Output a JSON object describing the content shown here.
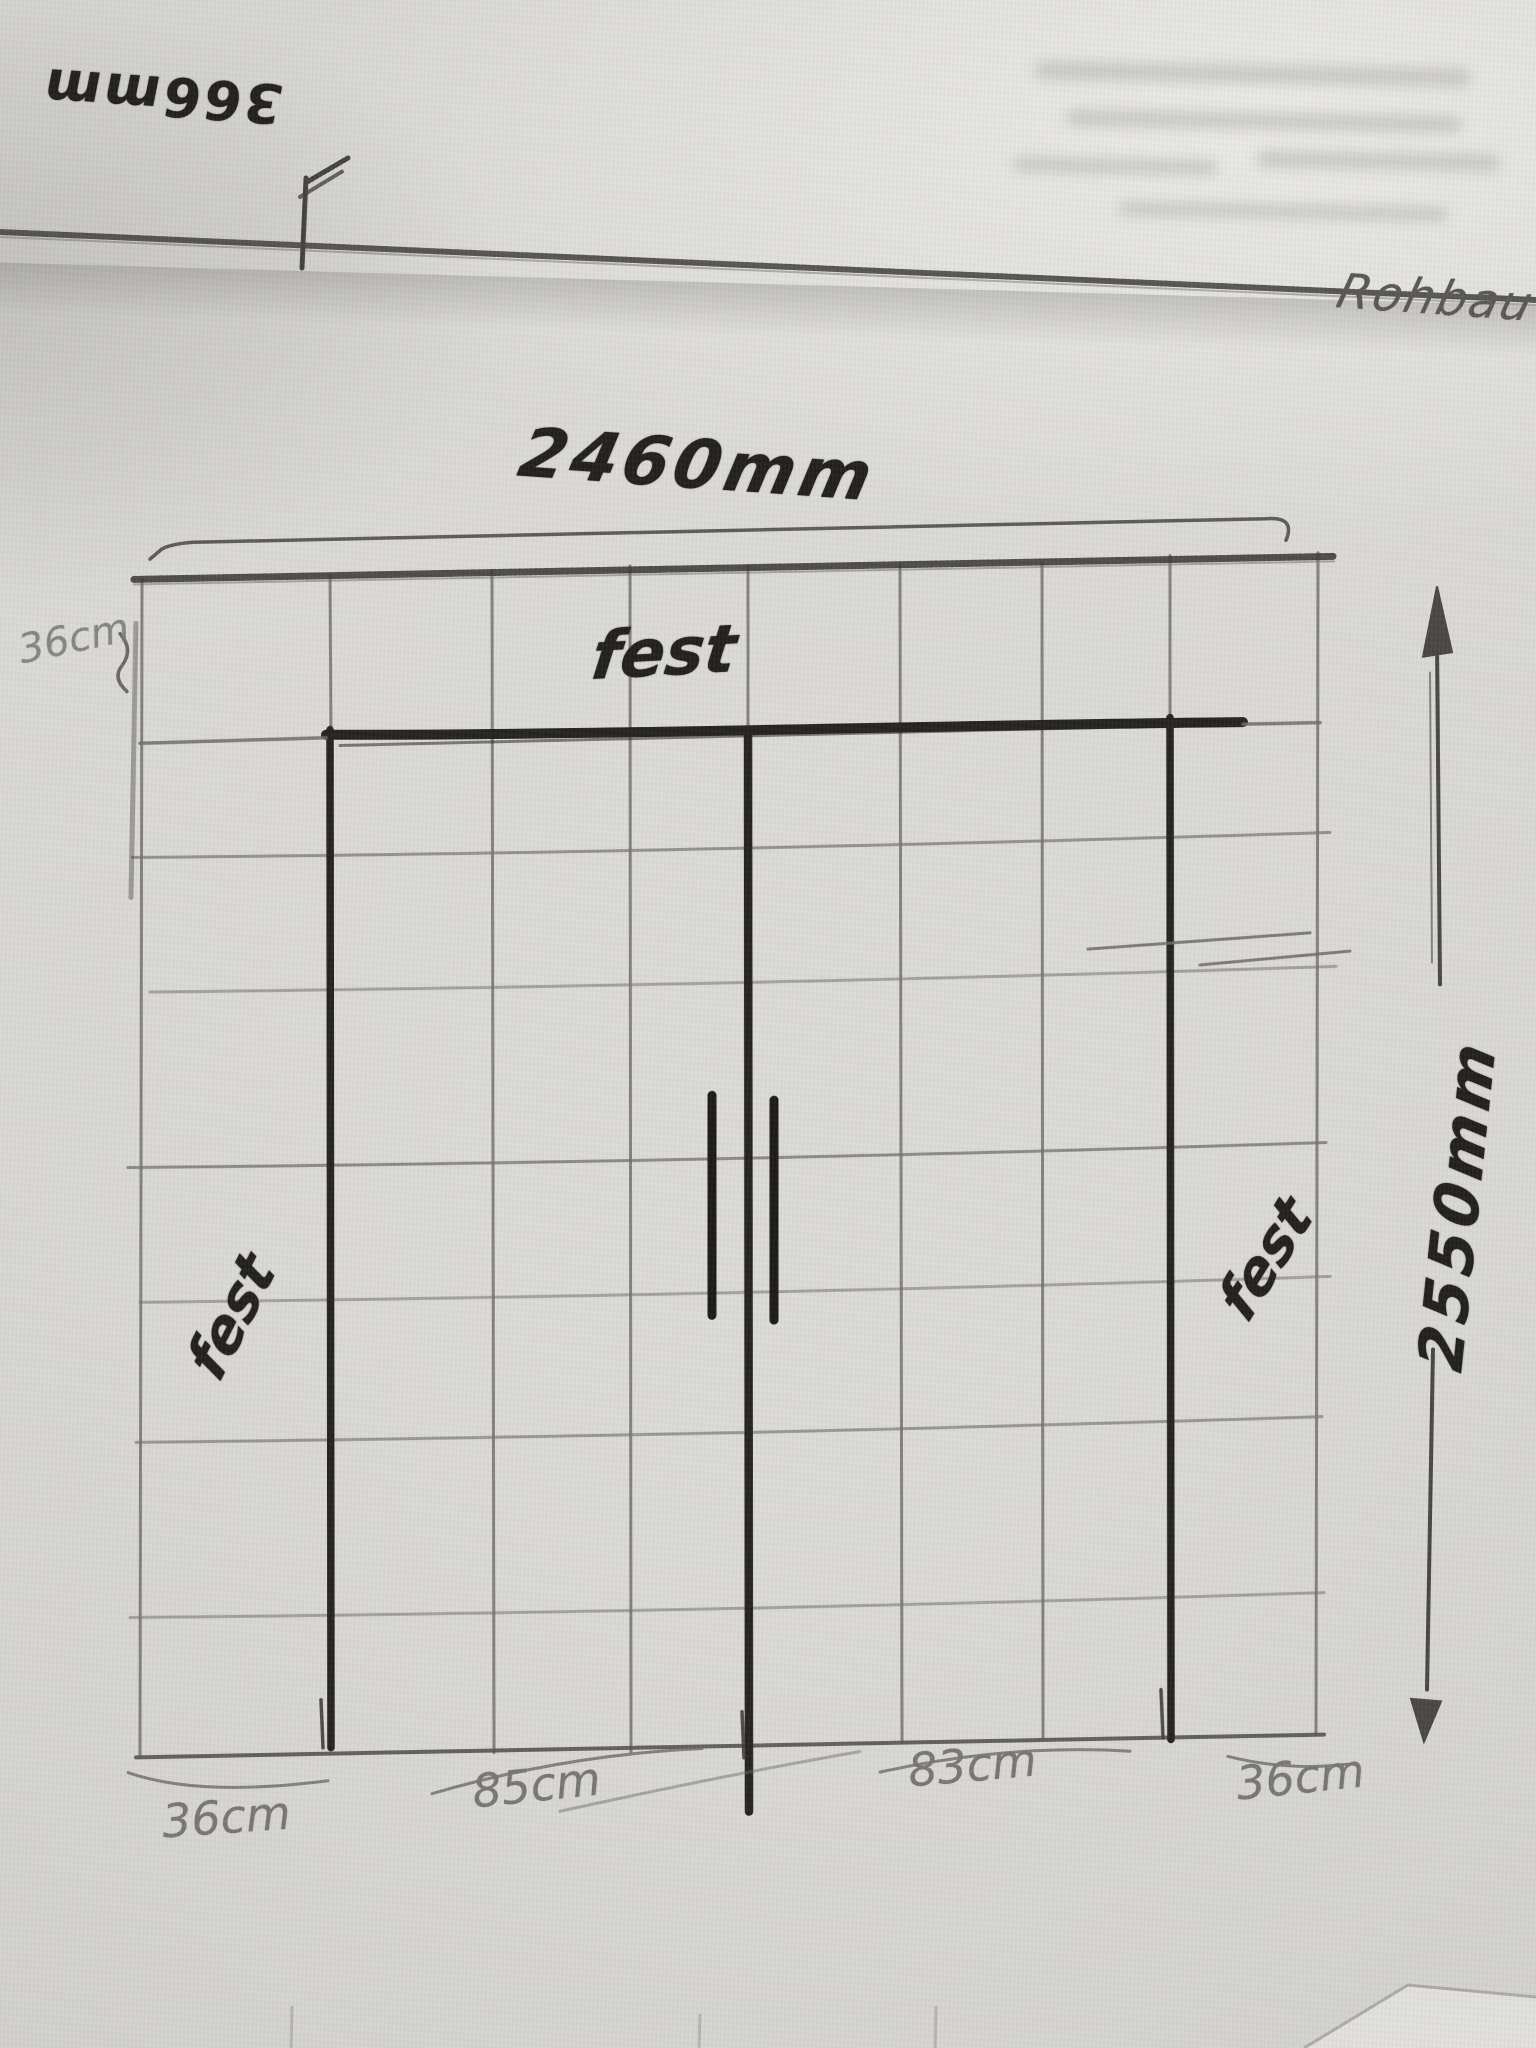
{
  "labels": {
    "strip_dim": "366mm",
    "note": "Rohbau",
    "width_dim": "2460mm",
    "height_dim": "2550mm",
    "left_margin_dim": "36cm",
    "fest_top": "fest",
    "fest_left": "fest",
    "fest_right": "fest",
    "bottom_dims": [
      "36cm",
      "85cm",
      "83cm",
      "36cm"
    ]
  },
  "colors": {
    "paper": "#d8d7d4",
    "pencil": "#6e6c68",
    "marker": "#24221f"
  }
}
